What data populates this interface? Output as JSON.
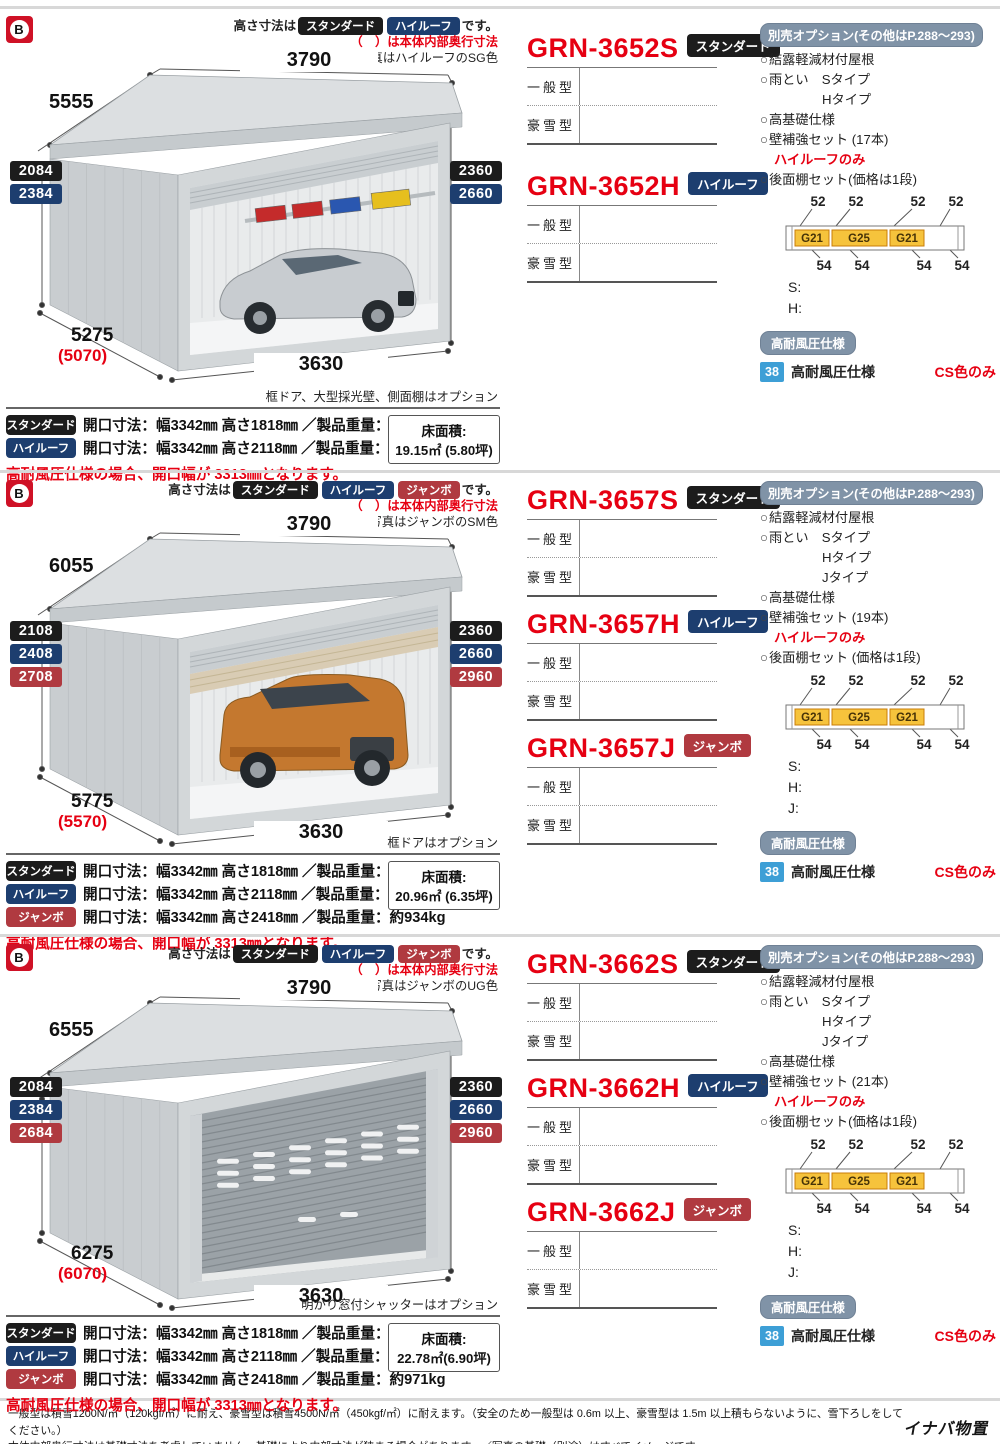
{
  "colors": {
    "accent_red": "#e60012",
    "badge": {
      "std": "#1c1c1c",
      "high": "#1d3e6f",
      "jumbo": "#b03a40"
    },
    "options_header_bg": "#8093a7",
    "wind_icon_blue": "#3d9fd6",
    "logo_red": "#cf1126"
  },
  "page": {
    "logo_letter": "B",
    "footer": {
      "line1": "一般型は積雪1200N/㎡（120kgf/㎡）に耐え、豪雪型は積雪4500N/㎡（450kgf/㎡）に耐えます。（安全のため一般型は 0.6m 以上、豪雪型は 1.5m 以上積もらないように、雪下ろしをしてください。）",
      "line2": "本体内部奥行寸法は基礎寸法を考慮していません。基礎により内部寸法が狭まる場合があります。／写真の基礎（別途）はすべてイメージです。",
      "brand": "イナバ物置"
    }
  },
  "sections": [
    {
      "height_note": {
        "prefix": "高さ寸法は",
        "suffix": "です。",
        "badges": [
          {
            "label": "スタンダード",
            "type": "std"
          },
          {
            "label": "ハイルーフ",
            "type": "high"
          }
        ]
      },
      "inner_note": "（　）は本体内部奥行寸法",
      "photo_note": "写真はハイルーフのSG色",
      "garage_style": "sedan",
      "dims": {
        "top_width": "3790",
        "depth": "5555",
        "left_heights": [
          {
            "value": "2084",
            "type": "std"
          },
          {
            "value": "2384",
            "type": "high"
          }
        ],
        "right_heights": [
          {
            "value": "2360",
            "type": "std"
          },
          {
            "value": "2660",
            "type": "high"
          }
        ],
        "bottom_depth": "5275",
        "bottom_depth_paren": "(5070)",
        "bottom_width": "3630"
      },
      "caption": "框ドア、大型採光壁、側面棚はオプション",
      "products": [
        {
          "code": "GRN-3652S",
          "badge": {
            "label": "スタンダード",
            "type": "std"
          },
          "rows": [
            "一般型",
            "豪雪型"
          ]
        },
        {
          "code": "GRN-3652H",
          "badge": {
            "label": "ハイルーフ",
            "type": "high"
          },
          "rows": [
            "一般型",
            "豪雪型"
          ]
        }
      ],
      "options": {
        "header": "別売オプション(その他はP.288～293)",
        "items": [
          {
            "text": "結露軽減材付屋根",
            "circle": true
          },
          {
            "text": "雨とい　Sタイプ",
            "circle": true
          },
          {
            "text": "Hタイプ",
            "indent": true
          },
          {
            "text": "高基礎仕様",
            "circle": true
          },
          {
            "text": "壁補強セット (17本)",
            "circle": true
          },
          {
            "text": "ハイルーフのみ",
            "red": true
          },
          {
            "text": "後面棚セット(価格は1段)",
            "circle": true
          }
        ],
        "shelf": {
          "top": [
            "52",
            "52",
            "52",
            "52"
          ],
          "boxes": [
            "G21",
            "G25",
            "G21"
          ],
          "bottom": [
            "54",
            "54",
            "54",
            "54"
          ]
        },
        "price_labels": [
          "S:",
          "H:"
        ]
      },
      "wind": {
        "badge": "高耐風圧仕様",
        "icon": "38",
        "text": "高耐風圧仕様",
        "note": "CS色のみ"
      },
      "specs": [
        {
          "badge": {
            "label": "スタンダード",
            "type": "std"
          },
          "text": "開口寸法：幅3342㎜ 高さ1818㎜ ／製品重量：約734kg"
        },
        {
          "badge": {
            "label": "ハイルーフ",
            "type": "high"
          },
          "text": "開口寸法：幅3342㎜ 高さ2118㎜ ／製品重量：約818kg"
        }
      ],
      "floor": {
        "label": "床面積:",
        "value": "19.15㎡ (5.80坪)"
      },
      "wind_note": "高耐風圧仕様の場合、開口幅が 3313㎜となります。"
    },
    {
      "height_note": {
        "prefix": "高さ寸法は",
        "suffix": "です。",
        "badges": [
          {
            "label": "スタンダード",
            "type": "std"
          },
          {
            "label": "ハイルーフ",
            "type": "high"
          },
          {
            "label": "ジャンボ",
            "type": "jumbo"
          }
        ]
      },
      "inner_note": "（　）は本体内部奥行寸法",
      "photo_note": "写真はジャンボのSM色",
      "garage_style": "suv",
      "dims": {
        "top_width": "3790",
        "depth": "6055",
        "left_heights": [
          {
            "value": "2108",
            "type": "std"
          },
          {
            "value": "2408",
            "type": "high"
          },
          {
            "value": "2708",
            "type": "jumbo"
          }
        ],
        "right_heights": [
          {
            "value": "2360",
            "type": "std"
          },
          {
            "value": "2660",
            "type": "high"
          },
          {
            "value": "2960",
            "type": "jumbo"
          }
        ],
        "bottom_depth": "5775",
        "bottom_depth_paren": "(5570)",
        "bottom_width": "3630"
      },
      "caption": "框ドアはオプション",
      "products": [
        {
          "code": "GRN-3657S",
          "badge": {
            "label": "スタンダード",
            "type": "std"
          },
          "rows": [
            "一般型",
            "豪雪型"
          ]
        },
        {
          "code": "GRN-3657H",
          "badge": {
            "label": "ハイルーフ",
            "type": "high"
          },
          "rows": [
            "一般型",
            "豪雪型"
          ]
        },
        {
          "code": "GRN-3657J",
          "badge": {
            "label": "ジャンボ",
            "type": "jumbo"
          },
          "rows": [
            "一般型",
            "豪雪型"
          ]
        }
      ],
      "options": {
        "header": "別売オプション(その他はP.288～293)",
        "items": [
          {
            "text": "結露軽減材付屋根",
            "circle": true
          },
          {
            "text": "雨とい　Sタイプ",
            "circle": true
          },
          {
            "text": "Hタイプ",
            "indent": true
          },
          {
            "text": "Jタイプ",
            "indent": true
          },
          {
            "text": "高基礎仕様",
            "circle": true
          },
          {
            "text": "壁補強セット (19本)",
            "circle": true
          },
          {
            "text": "ハイルーフのみ",
            "red": true
          },
          {
            "text": "後面棚セット (価格は1段)",
            "circle": true
          }
        ],
        "shelf": {
          "top": [
            "52",
            "52",
            "52",
            "52"
          ],
          "boxes": [
            "G21",
            "G25",
            "G21"
          ],
          "bottom": [
            "54",
            "54",
            "54",
            "54"
          ]
        },
        "price_labels": [
          "S:",
          "H:",
          "J:"
        ]
      },
      "wind": {
        "badge": "高耐風圧仕様",
        "icon": "38",
        "text": "高耐風圧仕様",
        "note": "CS色のみ"
      },
      "specs": [
        {
          "badge": {
            "label": "スタンダード",
            "type": "std"
          },
          "text": "開口寸法：幅3342㎜ 高さ1818㎜ ／製品重量：約770kg"
        },
        {
          "badge": {
            "label": "ハイルーフ",
            "type": "high"
          },
          "text": "開口寸法：幅3342㎜ 高さ2118㎜ ／製品重量：約858kg"
        },
        {
          "badge": {
            "label": "ジャンボ",
            "type": "jumbo"
          },
          "text": "開口寸法：幅3342㎜ 高さ2418㎜ ／製品重量：約934kg"
        }
      ],
      "floor": {
        "label": "床面積:",
        "value": "20.96㎡ (6.35坪)"
      },
      "wind_note": "高耐風圧仕様の場合、開口幅が 3313㎜となります。"
    },
    {
      "height_note": {
        "prefix": "高さ寸法は",
        "suffix": "です。",
        "badges": [
          {
            "label": "スタンダード",
            "type": "std"
          },
          {
            "label": "ハイルーフ",
            "type": "high"
          },
          {
            "label": "ジャンボ",
            "type": "jumbo"
          }
        ]
      },
      "inner_note": "（　）は本体内部奥行寸法",
      "photo_note": "写真はジャンボのUG色",
      "garage_style": "closed",
      "dims": {
        "top_width": "3790",
        "depth": "6555",
        "left_heights": [
          {
            "value": "2084",
            "type": "std"
          },
          {
            "value": "2384",
            "type": "high"
          },
          {
            "value": "2684",
            "type": "jumbo"
          }
        ],
        "right_heights": [
          {
            "value": "2360",
            "type": "std"
          },
          {
            "value": "2660",
            "type": "high"
          },
          {
            "value": "2960",
            "type": "jumbo"
          }
        ],
        "bottom_depth": "6275",
        "bottom_depth_paren": "(6070)",
        "bottom_width": "3630"
      },
      "caption": "明かり窓付シャッターはオプション",
      "products": [
        {
          "code": "GRN-3662S",
          "badge": {
            "label": "スタンダード",
            "type": "std"
          },
          "rows": [
            "一般型",
            "豪雪型"
          ]
        },
        {
          "code": "GRN-3662H",
          "badge": {
            "label": "ハイルーフ",
            "type": "high"
          },
          "rows": [
            "一般型",
            "豪雪型"
          ]
        },
        {
          "code": "GRN-3662J",
          "badge": {
            "label": "ジャンボ",
            "type": "jumbo"
          },
          "rows": [
            "一般型",
            "豪雪型"
          ]
        }
      ],
      "options": {
        "header": "別売オプション(その他はP.288～293)",
        "items": [
          {
            "text": "結露軽減材付屋根",
            "circle": true
          },
          {
            "text": "雨とい　Sタイプ",
            "circle": true
          },
          {
            "text": "Hタイプ",
            "indent": true
          },
          {
            "text": "Jタイプ",
            "indent": true
          },
          {
            "text": "高基礎仕様",
            "circle": true
          },
          {
            "text": "壁補強セット (21本)",
            "circle": true
          },
          {
            "text": "ハイルーフのみ",
            "red": true
          },
          {
            "text": "後面棚セット(価格は1段)",
            "circle": true
          }
        ],
        "shelf": {
          "top": [
            "52",
            "52",
            "52",
            "52"
          ],
          "boxes": [
            "G21",
            "G25",
            "G21"
          ],
          "bottom": [
            "54",
            "54",
            "54",
            "54"
          ]
        },
        "price_labels": [
          "S:",
          "H:",
          "J:"
        ]
      },
      "wind": {
        "badge": "高耐風圧仕様",
        "icon": "38",
        "text": "高耐風圧仕様",
        "note": "CS色のみ"
      },
      "specs": [
        {
          "badge": {
            "label": "スタンダード",
            "type": "std"
          },
          "text": "開口寸法：幅3342㎜ 高さ1818㎜ ／製品重量：約797kg"
        },
        {
          "badge": {
            "label": "ハイルーフ",
            "type": "high"
          },
          "text": "開口寸法：幅3342㎜ 高さ2118㎜ ／製品重量：約890kg"
        },
        {
          "badge": {
            "label": "ジャンボ",
            "type": "jumbo"
          },
          "text": "開口寸法：幅3342㎜ 高さ2418㎜ ／製品重量：約971kg"
        }
      ],
      "floor": {
        "label": "床面積:",
        "value": "22.78㎡(6.90坪)"
      },
      "wind_note": "高耐風圧仕様の場合、開口幅が 3313㎜となります。"
    }
  ]
}
